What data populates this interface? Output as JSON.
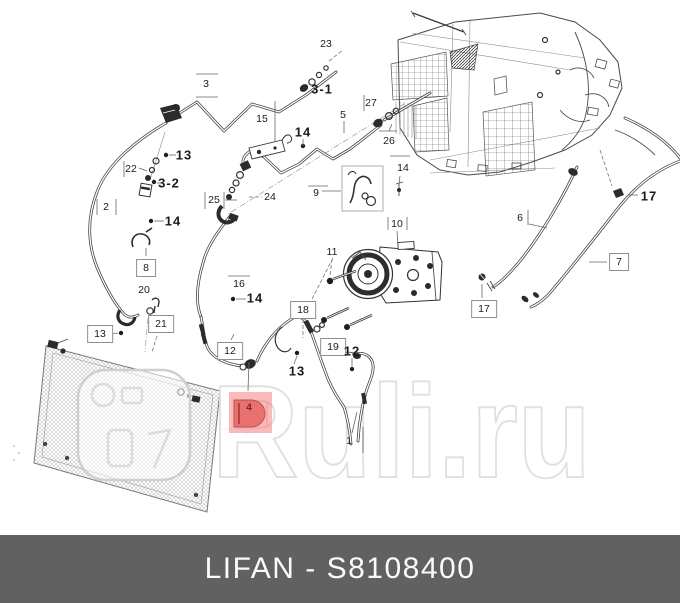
{
  "page": {
    "type": "auto-parts-catalog-diagram",
    "background": "#ffffff"
  },
  "diagram": {
    "description": "LIFAN air-conditioning system exploded parts diagram",
    "highlight": {
      "part": "4",
      "box_fill": "rgba(246,130,130,0.55)",
      "part_fill": "rgba(228,95,95,0.8)",
      "part_stroke": "#c05050",
      "bar_stroke": "#9c2a2a"
    },
    "labels": [
      {
        "text": "23",
        "x": 326,
        "y": 44,
        "style": "plain"
      },
      {
        "text": "3",
        "x": 206,
        "y": 84,
        "style": "plain"
      },
      {
        "text": "3-1",
        "x": 322,
        "y": 89,
        "style": "bold"
      },
      {
        "text": "27",
        "x": 371,
        "y": 103,
        "style": "plain"
      },
      {
        "text": "5",
        "x": 343,
        "y": 115,
        "style": "plain"
      },
      {
        "text": "15",
        "x": 262,
        "y": 119,
        "style": "plain"
      },
      {
        "text": "14",
        "x": 303,
        "y": 132,
        "style": "bold"
      },
      {
        "text": "26",
        "x": 389,
        "y": 141,
        "style": "plain"
      },
      {
        "text": "13",
        "x": 184,
        "y": 155,
        "style": "bold"
      },
      {
        "text": "14",
        "x": 403,
        "y": 168,
        "style": "plain"
      },
      {
        "text": "22",
        "x": 131,
        "y": 169,
        "style": "plain"
      },
      {
        "text": "3-2",
        "x": 169,
        "y": 183,
        "style": "bold"
      },
      {
        "text": "9",
        "x": 316,
        "y": 193,
        "style": "plain"
      },
      {
        "text": "17",
        "x": 649,
        "y": 196,
        "style": "bold"
      },
      {
        "text": "24",
        "x": 270,
        "y": 197,
        "style": "plain"
      },
      {
        "text": "25",
        "x": 214,
        "y": 200,
        "style": "plain"
      },
      {
        "text": "2",
        "x": 106,
        "y": 207,
        "style": "plain"
      },
      {
        "text": "6",
        "x": 520,
        "y": 218,
        "style": "plain"
      },
      {
        "text": "14",
        "x": 173,
        "y": 221,
        "style": "bold"
      },
      {
        "text": "10",
        "x": 397,
        "y": 224,
        "style": "plain"
      },
      {
        "text": "11",
        "x": 332,
        "y": 252,
        "style": "plain"
      },
      {
        "text": "7",
        "x": 619,
        "y": 262,
        "style": "boxed"
      },
      {
        "text": "8",
        "x": 146,
        "y": 268,
        "style": "boxed"
      },
      {
        "text": "16",
        "x": 239,
        "y": 284,
        "style": "plain"
      },
      {
        "text": "20",
        "x": 144,
        "y": 290,
        "style": "plain"
      },
      {
        "text": "14",
        "x": 255,
        "y": 298,
        "style": "bold"
      },
      {
        "text": "17",
        "x": 484,
        "y": 309,
        "style": "boxed"
      },
      {
        "text": "18",
        "x": 303,
        "y": 310,
        "style": "boxed"
      },
      {
        "text": "21",
        "x": 161,
        "y": 324,
        "style": "boxed"
      },
      {
        "text": "13",
        "x": 100,
        "y": 334,
        "style": "boxed"
      },
      {
        "text": "19",
        "x": 333,
        "y": 347,
        "style": "boxed"
      },
      {
        "text": "12",
        "x": 230,
        "y": 351,
        "style": "boxed"
      },
      {
        "text": "12",
        "x": 352,
        "y": 351,
        "style": "bold"
      },
      {
        "text": "13",
        "x": 297,
        "y": 371,
        "style": "bold"
      },
      {
        "text": "4",
        "x": 249,
        "y": 408,
        "style": "red"
      },
      {
        "text": "1",
        "x": 349,
        "y": 441,
        "style": "plain"
      }
    ]
  },
  "watermark": {
    "text": "Ruli.ru",
    "stroke_color": "#e0e0e0"
  },
  "footer": {
    "brand": "LIFAN",
    "part_number": "S8108400",
    "text": "LIFAN - S8108400",
    "background": "#616161"
  }
}
